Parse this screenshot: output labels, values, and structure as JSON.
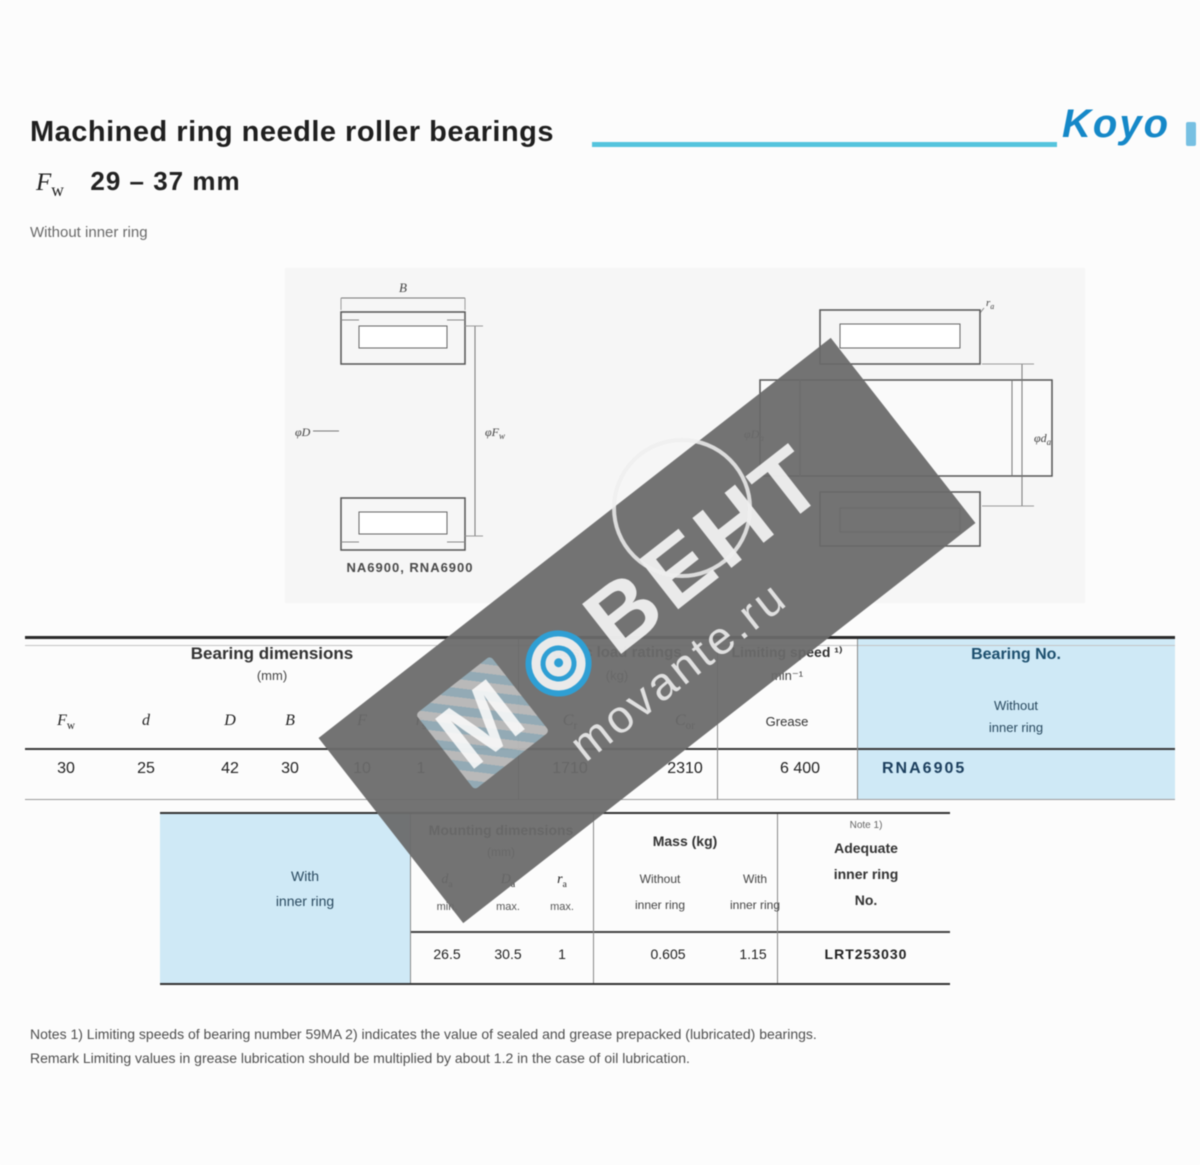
{
  "colors": {
    "accent_cyan": "#55c4dd",
    "brand_blue": "#1588c8",
    "table_blue": "#cfe9f6",
    "watermark_blue": "#2f9fd4"
  },
  "brand": {
    "logo_text": "Koyo"
  },
  "header": {
    "title": "Machined ring needle roller bearings",
    "bore_symbol_base": "F",
    "bore_symbol_sub": "w",
    "size_range": "29 – 37 mm",
    "variant": "Without inner ring"
  },
  "watermark": {
    "letter_m": "М",
    "brand_text": "ВЕНТ",
    "site": "movante.ru"
  },
  "diagrams": {
    "left": {
      "caption": "NA6900, RNA6900",
      "dim_top": "B",
      "dim_left": "φD",
      "dim_right_base": "φF",
      "dim_right_sub": "w"
    },
    "right": {
      "dim_top_base": "r",
      "dim_top_sub": "a",
      "dim_left_base": "φD",
      "dim_left_sub": "a",
      "dim_right_base": "φd",
      "dim_right_sub": "a"
    }
  },
  "table1": {
    "group_dimensions": {
      "title": "Bearing dimensions",
      "unit": "(mm)"
    },
    "group_loads": {
      "title": "Basic load ratings",
      "unit": "(kg)"
    },
    "group_speed": {
      "title": "Limiting speed ¹⁾",
      "unit": "min⁻¹",
      "sub": "Grease"
    },
    "group_bearing": {
      "title": "Bearing No.",
      "sub_line1": "Without",
      "sub_line2": "inner ring"
    },
    "symbols": [
      {
        "base": "F",
        "sub": "w"
      },
      {
        "base": "d",
        "sub": ""
      },
      {
        "base": "D",
        "sub": ""
      },
      {
        "base": "B",
        "sub": ""
      },
      {
        "base": "F",
        "sub": ""
      },
      {
        "base": "r",
        "sub": "s"
      }
    ],
    "load_symbols": [
      {
        "base": "C",
        "sub": "r"
      },
      {
        "base": "C",
        "sub": "or"
      }
    ],
    "row": {
      "dims": [
        "30",
        "25",
        "42",
        "30",
        "10",
        "1"
      ],
      "cr": "1710",
      "cor": "2310",
      "speed": "6 400",
      "bearing_no": "RNA6905"
    }
  },
  "table2": {
    "side": {
      "line1": "With",
      "line2": "inner ring"
    },
    "group_mounting": {
      "title": "Mounting dimensions",
      "unit": "(mm)"
    },
    "mount_symbols": [
      {
        "base": "d",
        "sub": "a"
      },
      {
        "base": "D",
        "sub": "a"
      },
      {
        "base": "r",
        "sub": "a"
      }
    ],
    "mount_limits": [
      "min.",
      "max.",
      "max."
    ],
    "group_mass": {
      "title": "Mass (kg)",
      "col1_line1": "Without",
      "col1_line2": "inner ring",
      "col2_line1": "With",
      "col2_line2": "inner ring"
    },
    "group_ring": {
      "note": "Note 1)",
      "line1": "Adequate",
      "line2": "inner ring",
      "line3": "No."
    },
    "row": {
      "da": "26.5",
      "Da": "30.5",
      "ra": "1",
      "mass_without": "0.605",
      "mass_with": "1.15",
      "ring_no": "LRT253030"
    }
  },
  "notes": {
    "line1": "Notes    1) Limiting speeds of bearing number 59MA   2) indicates the value of sealed and grease prepacked (lubricated) bearings.",
    "line2": "Remark   Limiting values in grease lubrication should be multiplied by about 1.2 in the case of oil lubrication."
  }
}
